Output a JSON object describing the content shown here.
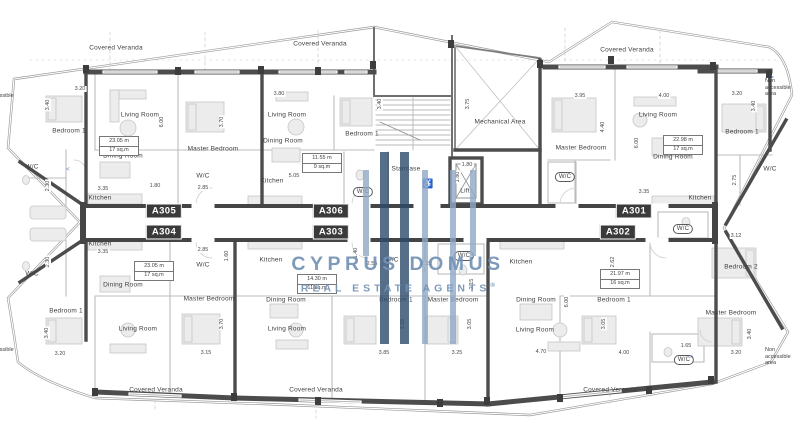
{
  "watermark": {
    "line1": "CYPRUS DOMUS",
    "line2": "REAL ESTATE AGENTS",
    "registered": "®",
    "color_dark": "#2e4a6b",
    "color_light": "#8fa9c6",
    "text_color": "#7392b5"
  },
  "units": [
    {
      "id": "A305",
      "x": 164,
      "y": 211
    },
    {
      "id": "A304",
      "x": 164,
      "y": 232
    },
    {
      "id": "A306",
      "x": 331,
      "y": 211
    },
    {
      "id": "A303",
      "x": 331,
      "y": 232
    },
    {
      "id": "A301",
      "x": 634,
      "y": 211
    },
    {
      "id": "A302",
      "x": 618,
      "y": 232
    }
  ],
  "rooms": [
    {
      "t": "Covered Veranda",
      "x": 116,
      "y": 48
    },
    {
      "t": "Covered Veranda",
      "x": 320,
      "y": 44
    },
    {
      "t": "Covered Veranda",
      "x": 627,
      "y": 50
    },
    {
      "t": "Covered Veranda",
      "x": 156,
      "y": 390
    },
    {
      "t": "Covered Veranda",
      "x": 316,
      "y": 390
    },
    {
      "t": "Covered Veranda",
      "x": 610,
      "y": 390
    },
    {
      "t": "Bedroom 1",
      "x": 69,
      "y": 131
    },
    {
      "t": "Living Room",
      "x": 140,
      "y": 115
    },
    {
      "t": "Master Bedroom",
      "x": 213,
      "y": 149
    },
    {
      "t": "Dining Room",
      "x": 123,
      "y": 156
    },
    {
      "t": "Kitchen",
      "x": 100,
      "y": 198
    },
    {
      "t": "W/C",
      "x": 32,
      "y": 167
    },
    {
      "t": "W/C",
      "x": 203,
      "y": 176
    },
    {
      "t": "Living Room",
      "x": 287,
      "y": 115
    },
    {
      "t": "Dining Room",
      "x": 283,
      "y": 141
    },
    {
      "t": "Bedroom 1",
      "x": 362,
      "y": 134
    },
    {
      "t": "Kitchen",
      "x": 272,
      "y": 181
    },
    {
      "t": "W/C",
      "x": 363,
      "y": 192,
      "pill": true
    },
    {
      "t": "Staircase",
      "x": 406,
      "y": 169
    },
    {
      "t": "Lift",
      "x": 465,
      "y": 191
    },
    {
      "t": "Mechanical Area",
      "x": 500,
      "y": 122
    },
    {
      "t": "Master Bedroom",
      "x": 581,
      "y": 148
    },
    {
      "t": "W/C",
      "x": 565,
      "y": 177,
      "pill": true
    },
    {
      "t": "Living Room",
      "x": 658,
      "y": 115
    },
    {
      "t": "Dining Room",
      "x": 673,
      "y": 157
    },
    {
      "t": "Kitchen",
      "x": 700,
      "y": 198
    },
    {
      "t": "Bedroom 1",
      "x": 742,
      "y": 132
    },
    {
      "t": "W/C",
      "x": 770,
      "y": 169
    },
    {
      "t": "W/C",
      "x": 32,
      "y": 274
    },
    {
      "t": "Kitchen",
      "x": 100,
      "y": 244
    },
    {
      "t": "Dining Room",
      "x": 123,
      "y": 285
    },
    {
      "t": "W/C",
      "x": 203,
      "y": 265
    },
    {
      "t": "Master Bedroom",
      "x": 209,
      "y": 299
    },
    {
      "t": "Bedroom 1",
      "x": 66,
      "y": 311
    },
    {
      "t": "Living Room",
      "x": 138,
      "y": 329
    },
    {
      "t": "Kitchen",
      "x": 271,
      "y": 260
    },
    {
      "t": "Dining Room",
      "x": 286,
      "y": 300
    },
    {
      "t": "Living Room",
      "x": 287,
      "y": 329
    },
    {
      "t": "Bedroom 1",
      "x": 396,
      "y": 300
    },
    {
      "t": "Master Bedroom",
      "x": 453,
      "y": 300
    },
    {
      "t": "W/C",
      "x": 392,
      "y": 260
    },
    {
      "t": "W/C",
      "x": 464,
      "y": 256,
      "pill": true
    },
    {
      "t": "Kitchen",
      "x": 521,
      "y": 262
    },
    {
      "t": "Dining Room",
      "x": 536,
      "y": 300
    },
    {
      "t": "Living Room",
      "x": 535,
      "y": 330
    },
    {
      "t": "Bedroom 1",
      "x": 614,
      "y": 300
    },
    {
      "t": "Master Bedroom",
      "x": 731,
      "y": 313
    },
    {
      "t": "W/C",
      "x": 683,
      "y": 229,
      "pill": true
    },
    {
      "t": "Bedroom 2",
      "x": 741,
      "y": 267
    },
    {
      "t": "W/C",
      "x": 684,
      "y": 360,
      "pill": true
    }
  ],
  "notes": [
    {
      "t": "Non accessible Area",
      "x": 3,
      "y": 96
    },
    {
      "t": "Non accessible area",
      "x": 780,
      "y": 88
    },
    {
      "t": "Non accessible Area",
      "x": 3,
      "y": 350
    },
    {
      "t": "Non accessible area",
      "x": 780,
      "y": 357
    }
  ],
  "dims_h": [
    {
      "t": "3.20",
      "x": 80,
      "y": 89
    },
    {
      "t": "3.80",
      "x": 279,
      "y": 94
    },
    {
      "t": "3.95",
      "x": 580,
      "y": 96
    },
    {
      "t": "4.00",
      "x": 664,
      "y": 96
    },
    {
      "t": "3.20",
      "x": 737,
      "y": 94
    },
    {
      "t": "3.35",
      "x": 103,
      "y": 189
    },
    {
      "t": "1.80",
      "x": 155,
      "y": 186
    },
    {
      "t": "2.85",
      "x": 203,
      "y": 188
    },
    {
      "t": "5.05",
      "x": 294,
      "y": 176
    },
    {
      "t": "1.80",
      "x": 467,
      "y": 165
    },
    {
      "t": "3.35",
      "x": 644,
      "y": 192
    },
    {
      "t": "3.35",
      "x": 103,
      "y": 252
    },
    {
      "t": "2.85",
      "x": 203,
      "y": 250
    },
    {
      "t": "2.55",
      "x": 372,
      "y": 264
    },
    {
      "t": "2.15",
      "x": 426,
      "y": 264
    },
    {
      "t": "3.12",
      "x": 736,
      "y": 236
    },
    {
      "t": "3.20",
      "x": 60,
      "y": 354
    },
    {
      "t": "3.15",
      "x": 206,
      "y": 353
    },
    {
      "t": "3.85",
      "x": 384,
      "y": 353
    },
    {
      "t": "3.25",
      "x": 457,
      "y": 353
    },
    {
      "t": "4.70",
      "x": 541,
      "y": 352
    },
    {
      "t": "4.00",
      "x": 624,
      "y": 353
    },
    {
      "t": "1.65",
      "x": 686,
      "y": 346
    },
    {
      "t": "3.20",
      "x": 736,
      "y": 353
    }
  ],
  "dims_v": [
    {
      "t": "3.40",
      "x": 48,
      "y": 105
    },
    {
      "t": "6.00",
      "x": 162,
      "y": 122
    },
    {
      "t": "3.70",
      "x": 222,
      "y": 122
    },
    {
      "t": "3.40",
      "x": 380,
      "y": 104
    },
    {
      "t": "3.75",
      "x": 468,
      "y": 104
    },
    {
      "t": "4.40",
      "x": 603,
      "y": 127
    },
    {
      "t": "6.00",
      "x": 637,
      "y": 143
    },
    {
      "t": "3.40",
      "x": 754,
      "y": 106
    },
    {
      "t": "2.30",
      "x": 48,
      "y": 186
    },
    {
      "t": "2.30",
      "x": 48,
      "y": 262
    },
    {
      "t": "1.80",
      "x": 458,
      "y": 177
    },
    {
      "t": "1.40",
      "x": 356,
      "y": 253
    },
    {
      "t": "1.60",
      "x": 227,
      "y": 256
    },
    {
      "t": "2.75",
      "x": 735,
      "y": 180
    },
    {
      "t": "2.62",
      "x": 613,
      "y": 262
    },
    {
      "t": "2.15",
      "x": 472,
      "y": 284
    },
    {
      "t": "6.00",
      "x": 567,
      "y": 302
    },
    {
      "t": "3.40",
      "x": 47,
      "y": 333
    },
    {
      "t": "3.70",
      "x": 222,
      "y": 324
    },
    {
      "t": "3.05",
      "x": 403,
      "y": 324
    },
    {
      "t": "3.05",
      "x": 470,
      "y": 324
    },
    {
      "t": "3.05",
      "x": 604,
      "y": 324
    },
    {
      "t": "3.40",
      "x": 750,
      "y": 334
    }
  ],
  "area_boxes": [
    {
      "l1": "23.05 m",
      "l2": "17 sq.m",
      "x": 119,
      "y": 146
    },
    {
      "l1": "11.55 m",
      "l2": "9 sq.m",
      "x": 322,
      "y": 163
    },
    {
      "l1": "22.98 m",
      "l2": "17 sq.m",
      "x": 683,
      "y": 145
    },
    {
      "l1": "23.05 m",
      "l2": "17 sq.m",
      "x": 154,
      "y": 271
    },
    {
      "l1": "14.30 m",
      "l2": "11 sq.m",
      "x": 317,
      "y": 284
    },
    {
      "l1": "21.97 m",
      "l2": "16 sq.m",
      "x": 620,
      "y": 279
    }
  ],
  "icons": [
    {
      "name": "accessibility-icon",
      "glyph": "♿",
      "x": 428,
      "y": 184,
      "size": 9,
      "color": "#6b8ad0"
    },
    {
      "name": "annotation-marker",
      "glyph": "^",
      "x": 692,
      "y": 359,
      "size": 7,
      "color": "#5b7fd4"
    },
    {
      "name": "annotation-marker",
      "glyph": "<",
      "x": 68,
      "y": 170,
      "size": 6,
      "color": "#5b7fd4"
    },
    {
      "name": "annotation-marker",
      "glyph": ">",
      "x": 772,
      "y": 78,
      "size": 6,
      "color": "#5b7fd4"
    }
  ]
}
